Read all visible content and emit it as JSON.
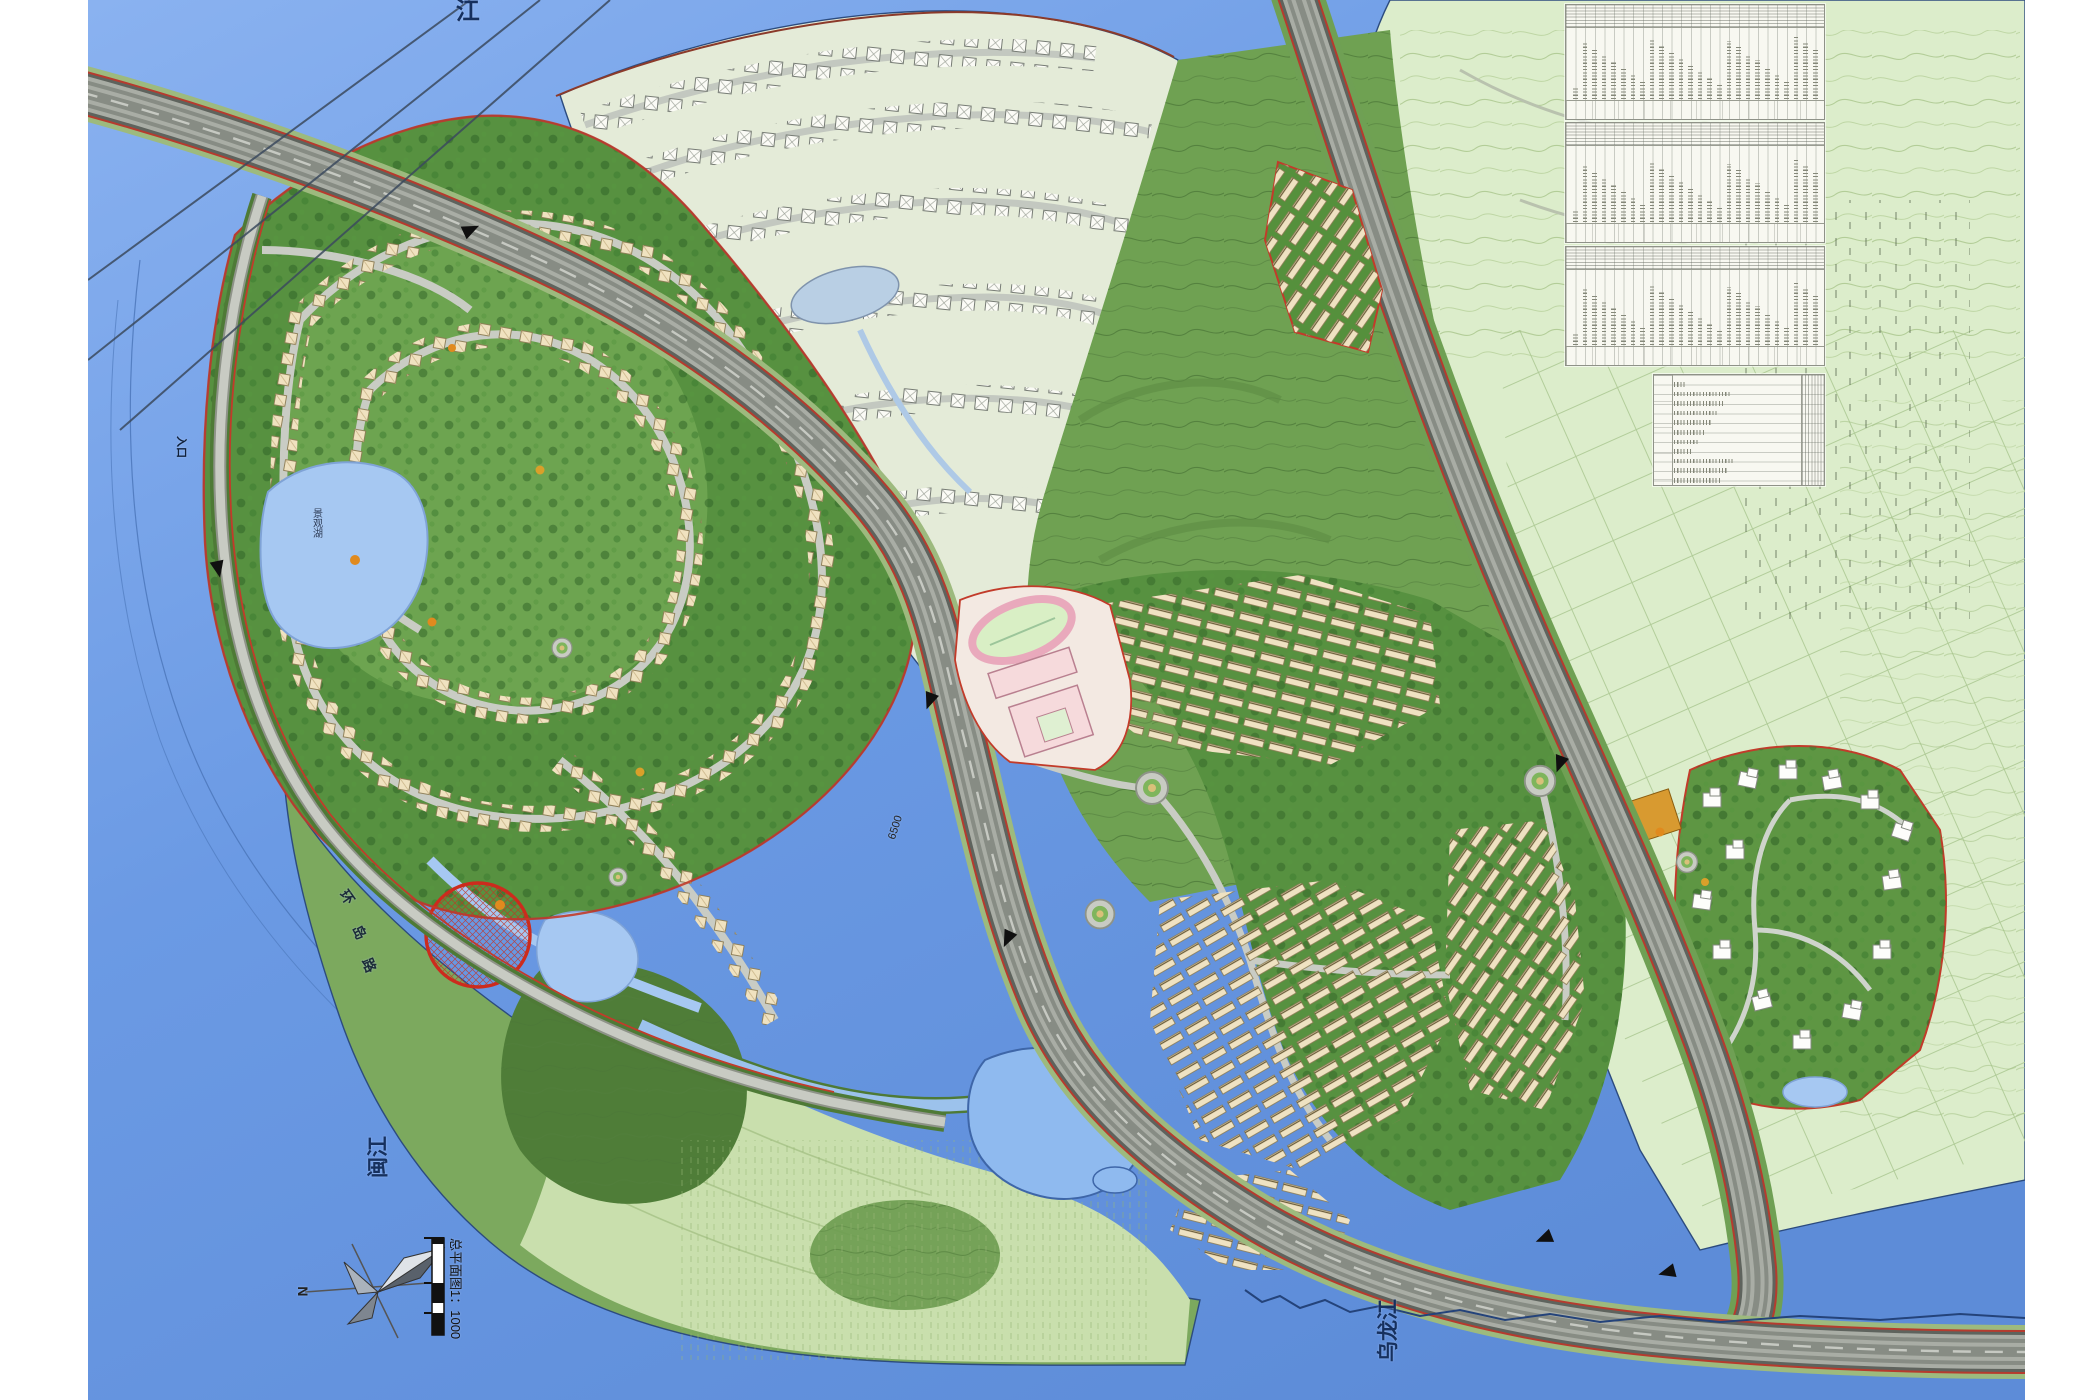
{
  "map": {
    "rivers": {
      "top": "闽江",
      "left": "闽江",
      "bottom": "乌龙江"
    },
    "roads": {
      "ring_char_1": "环",
      "ring_char_2": "岛",
      "ring_char_3": "路",
      "dimension": "6500"
    },
    "poi": {
      "entrance": "入口",
      "lake": "景观湖"
    },
    "legend": {
      "north": "N",
      "scale_title": "总平面图1：1000"
    },
    "colors": {
      "water": "#6B9AE4",
      "hill_green": "#6FA152",
      "community_green": "#579140",
      "farmland": "#DCEDCB",
      "existing_area": "#E4EBD8",
      "road_gray": "#A9ADA5",
      "boundary_red": "#C23B2A",
      "building_cream": "#EFE2C2",
      "pond_blue": "#9DC4F2",
      "school_pink": "#F3D9DC",
      "orange_building": "#D89A30"
    },
    "tables_count": "4"
  }
}
